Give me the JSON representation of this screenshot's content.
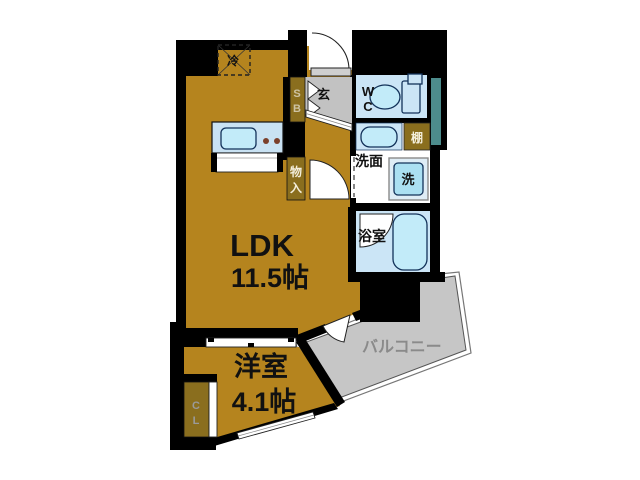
{
  "floor_plan": {
    "rooms": {
      "ldk": {
        "name": "LDK",
        "size": "11.5帖"
      },
      "western_room": {
        "name": "洋室",
        "size": "4.1帖"
      },
      "balcony": {
        "name": "バルコニー"
      },
      "bathroom": {
        "name": "浴室"
      },
      "washroom": {
        "name": "洗面"
      },
      "toilet": {
        "abbr_line1": "W",
        "abbr_line2": "C"
      },
      "entrance": {
        "abbr": "玄"
      }
    },
    "fixtures": {
      "refrigerator": {
        "abbr": "冷"
      },
      "shoe_box": {
        "abbr_line1": "S",
        "abbr_line2": "B"
      },
      "shelf": {
        "abbr": "棚"
      },
      "washing_machine": {
        "abbr": "洗"
      },
      "storage": {
        "abbr_line1": "物",
        "abbr_line2": "入"
      },
      "closet": {
        "abbr_line1": "C",
        "abbr_line2": "L"
      }
    },
    "colors": {
      "wall": "#000000",
      "room_floor": "#B5841E",
      "cabinet": "#8A6E1E",
      "balcony_floor": "#C6C6C6",
      "entrance_floor": "#C2C2C2",
      "wet_room_floor": "#CBE5F6",
      "fixture_fill": "#C2EBF9",
      "counter": "#C9E2F3",
      "washer_fill": "#ABE0F2",
      "duct": "#4D8C8C",
      "label_gray": "#8A8A8A"
    }
  }
}
